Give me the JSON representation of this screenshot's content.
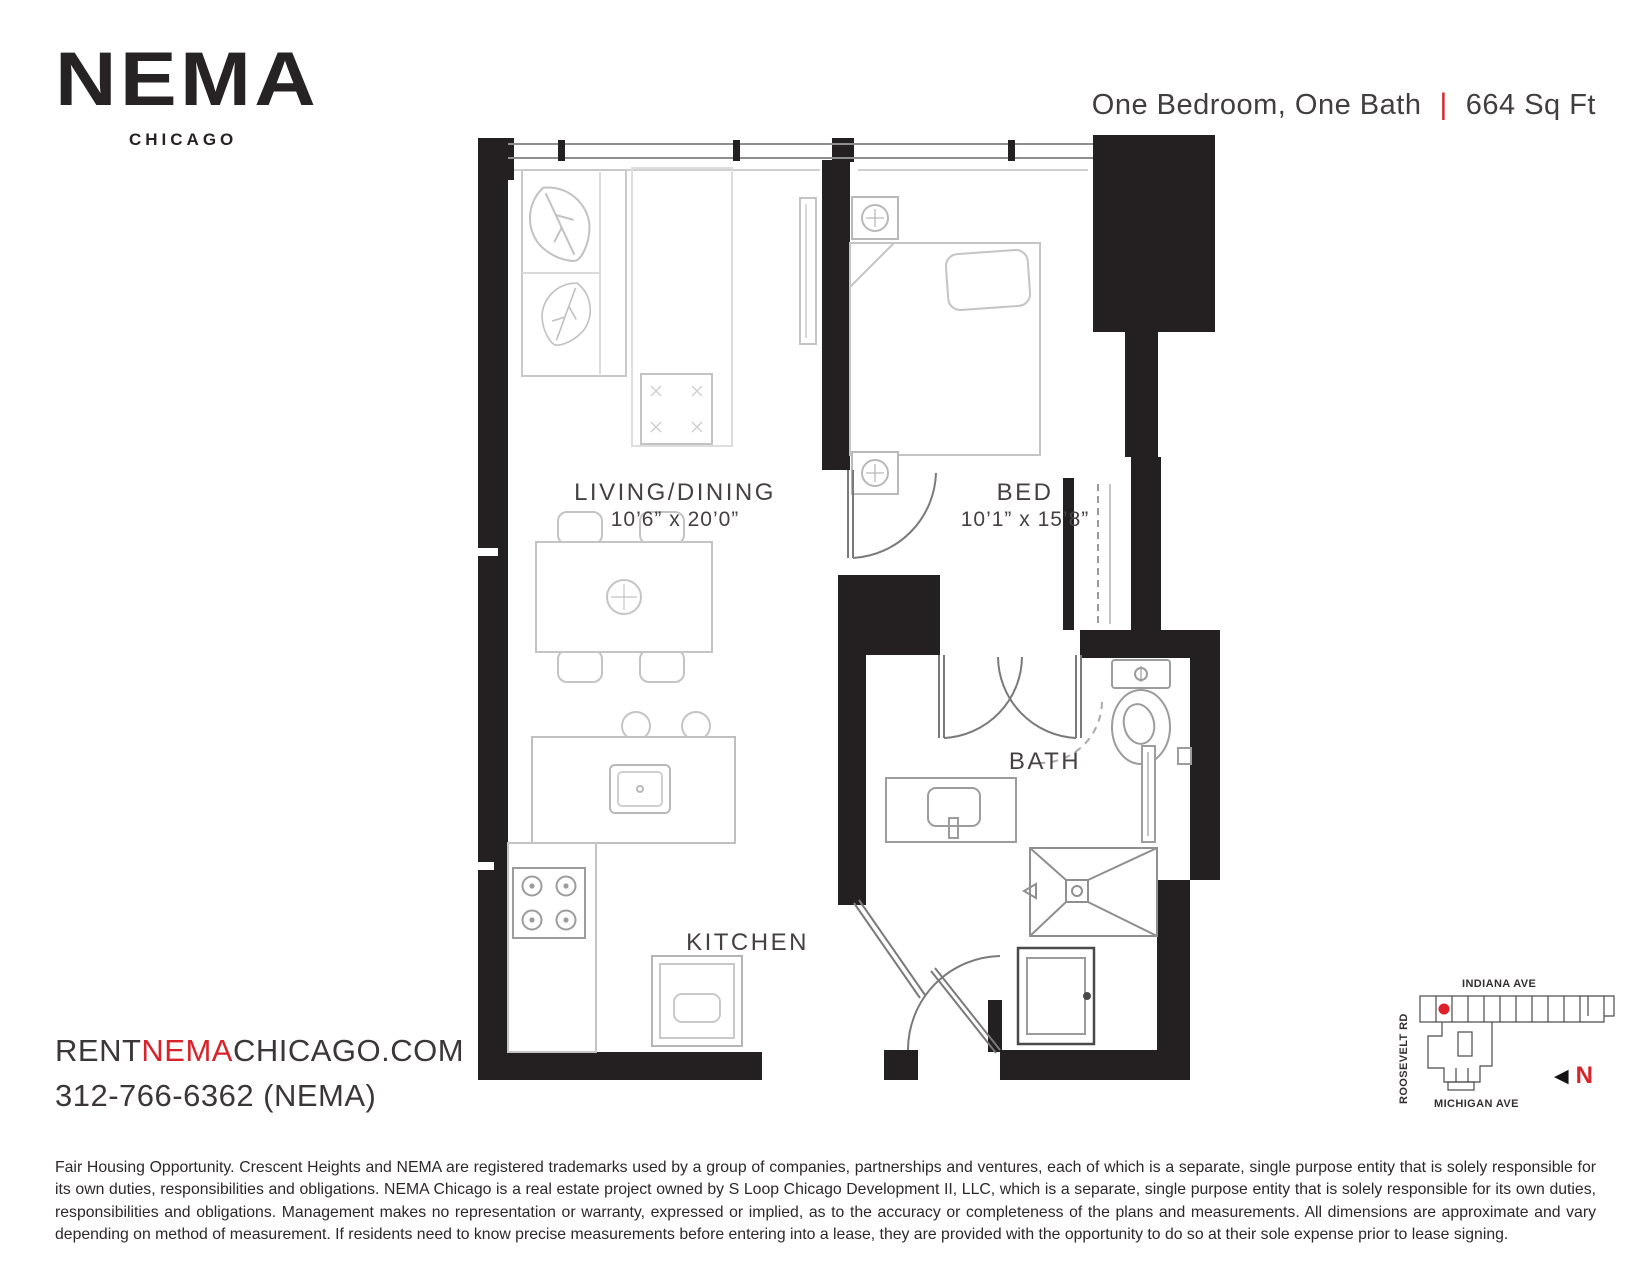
{
  "brand": {
    "logo": "NEMA",
    "city": "CHICAGO"
  },
  "header": {
    "title": "One Bedroom, One Bath",
    "separator": "|",
    "area": "664 Sq Ft"
  },
  "rooms": {
    "living": {
      "name": "LIVING/DINING",
      "dimensions": "10’6” x 20’0”"
    },
    "bed": {
      "name": "BED",
      "dimensions": "10’1” x 15’8”"
    },
    "bath": {
      "name": "BATH"
    },
    "kitchen": {
      "name": "KITCHEN"
    }
  },
  "contact": {
    "website": {
      "prefix": "RENT",
      "highlight": "NEMA",
      "suffix": "CHICAGO.COM"
    },
    "phone": "312-766-6362 (NEMA)"
  },
  "site_map": {
    "streets": {
      "top": "INDIANA AVE",
      "left": "ROOSEVELT RD",
      "bottom": "MICHIGAN AVE"
    },
    "north_arrow_glyph": "◀",
    "north_label": "N"
  },
  "disclaimer": "Fair Housing Opportunity. Crescent Heights and NEMA are registered trademarks used by a group of companies, partnerships and ventures, each of which is a separate, single purpose entity that is solely responsible for its own duties, responsibilities and obligations. NEMA Chicago is a real estate project owned by S Loop Chicago Development II, LLC, which is a separate, single purpose entity that is solely responsible for its own duties, responsibilities and obligations. Management makes no representation or warranty, expressed or implied, as to the accuracy or completeness of the plans and measurements. All dimensions are approximate and vary depending on method of measurement. If residents need to know precise measurements before entering into a lease, they are provided with the opportunity to do so at their sole expense prior to lease signing.",
  "colors": {
    "accent_red": "#d8232a",
    "wall_black": "#241f20"
  }
}
